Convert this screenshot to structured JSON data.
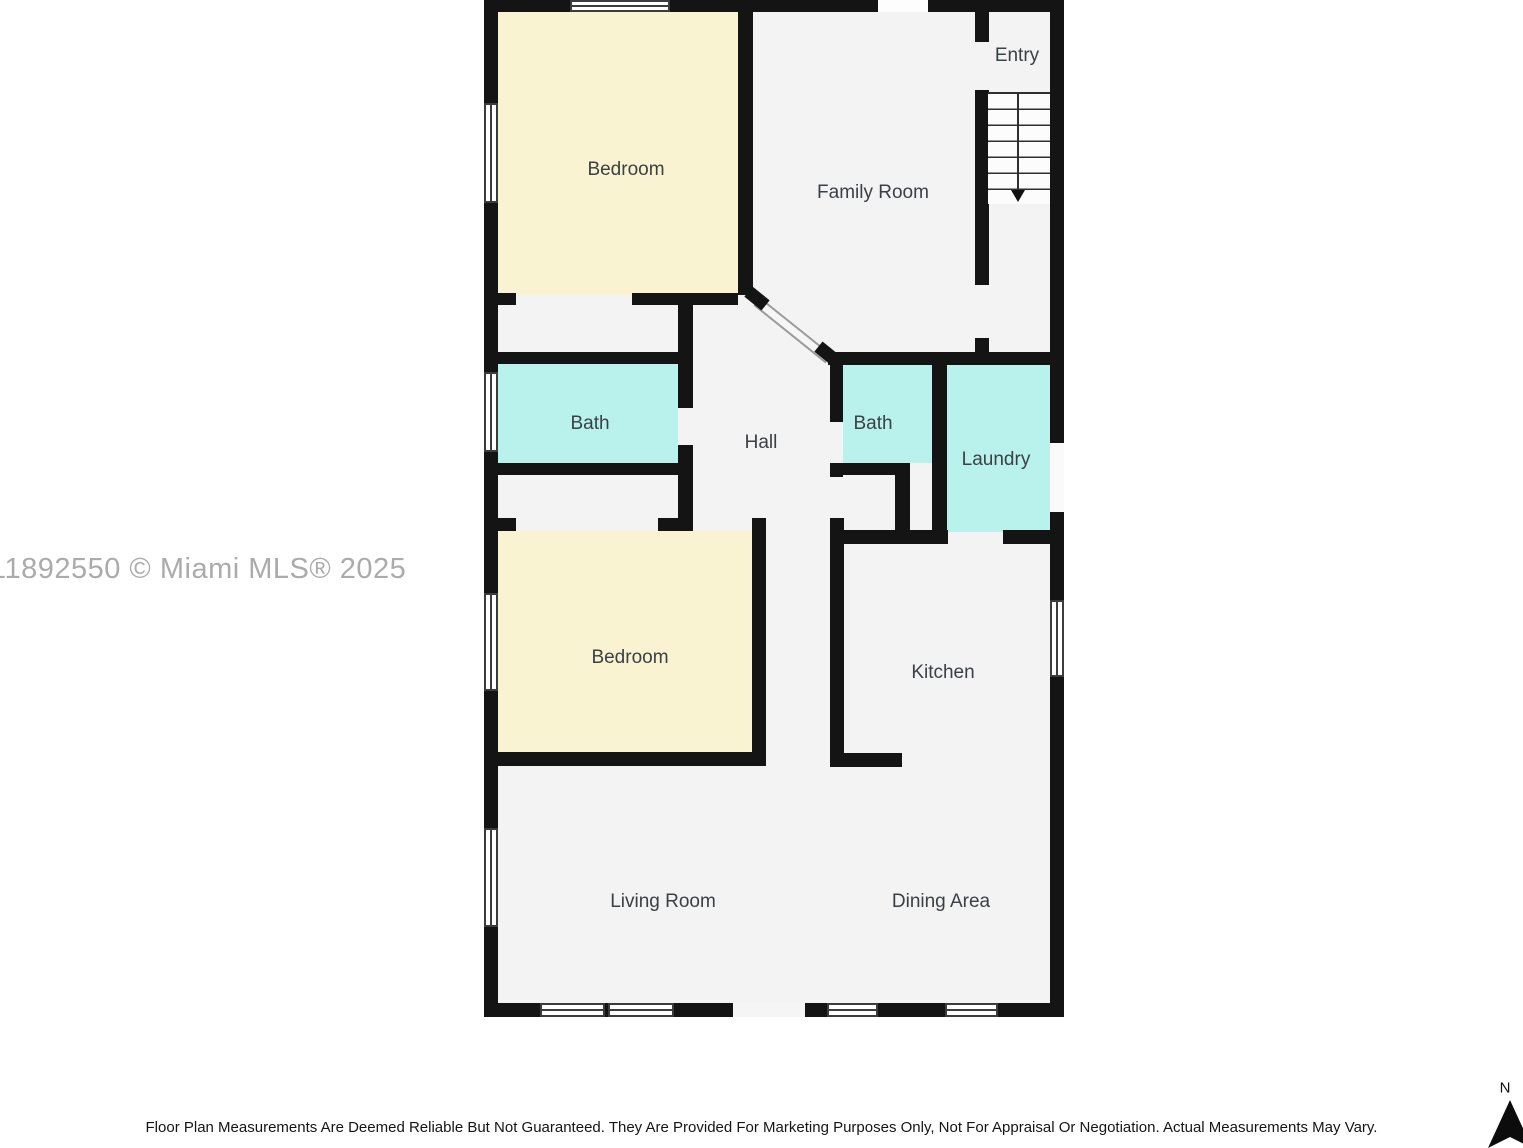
{
  "watermark_text": "11892550 © Miami MLS® 2025",
  "disclaimer_text": "Floor Plan Measurements Are Deemed Reliable But Not Guaranteed. They Are Provided For Marketing Purposes Only, Not For Appraisal Or Negotiation. Actual Measurements May Vary.",
  "compass": {
    "label": "N"
  },
  "colors": {
    "bedroom_fill": "#FAF3D1",
    "bath_fill": "#B9F2ED",
    "floor_fill": "#F3F3F3",
    "wall": "#141414"
  },
  "rooms": [
    {
      "id": "bedroom-upper",
      "label": "Bedroom"
    },
    {
      "id": "family-room",
      "label": "Family Room"
    },
    {
      "id": "entry",
      "label": "Entry"
    },
    {
      "id": "bath-left",
      "label": "Bath"
    },
    {
      "id": "hall",
      "label": "Hall"
    },
    {
      "id": "bath-right",
      "label": "Bath"
    },
    {
      "id": "laundry",
      "label": "Laundry"
    },
    {
      "id": "bedroom-lower",
      "label": "Bedroom"
    },
    {
      "id": "kitchen",
      "label": "Kitchen"
    },
    {
      "id": "living-room",
      "label": "Living Room"
    },
    {
      "id": "dining-area",
      "label": "Dining Area"
    }
  ]
}
